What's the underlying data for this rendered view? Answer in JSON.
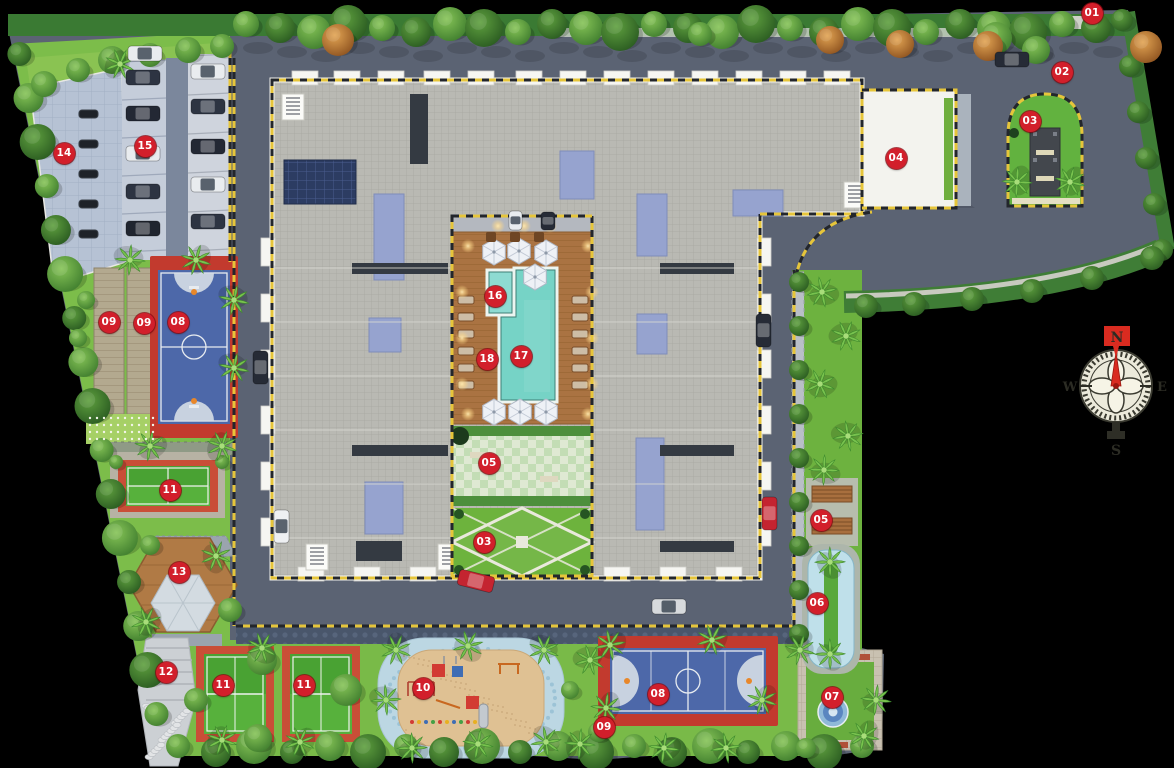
{
  "plan": {
    "title": "residential-site-plan",
    "markers": [
      {
        "label": "01",
        "x": 1092,
        "y": 13
      },
      {
        "label": "02",
        "x": 1062,
        "y": 72
      },
      {
        "label": "03",
        "x": 1030,
        "y": 121
      },
      {
        "label": "04",
        "x": 896,
        "y": 158
      },
      {
        "label": "14",
        "x": 64,
        "y": 153
      },
      {
        "label": "15",
        "x": 145,
        "y": 146
      },
      {
        "label": "09",
        "x": 109,
        "y": 322
      },
      {
        "label": "09",
        "x": 144,
        "y": 323
      },
      {
        "label": "08",
        "x": 178,
        "y": 322
      },
      {
        "label": "16",
        "x": 495,
        "y": 296
      },
      {
        "label": "18",
        "x": 487,
        "y": 359
      },
      {
        "label": "17",
        "x": 521,
        "y": 356
      },
      {
        "label": "05",
        "x": 489,
        "y": 463
      },
      {
        "label": "03",
        "x": 484,
        "y": 542
      },
      {
        "label": "11",
        "x": 170,
        "y": 490
      },
      {
        "label": "13",
        "x": 179,
        "y": 572
      },
      {
        "label": "12",
        "x": 166,
        "y": 672
      },
      {
        "label": "11",
        "x": 223,
        "y": 685
      },
      {
        "label": "11",
        "x": 304,
        "y": 685
      },
      {
        "label": "10",
        "x": 423,
        "y": 688
      },
      {
        "label": "09",
        "x": 604,
        "y": 727
      },
      {
        "label": "08",
        "x": 658,
        "y": 694
      },
      {
        "label": "07",
        "x": 832,
        "y": 697
      },
      {
        "label": "05",
        "x": 821,
        "y": 520
      },
      {
        "label": "06",
        "x": 817,
        "y": 603
      }
    ],
    "compass": {
      "north": "N",
      "east": "E",
      "south": "S",
      "west": "W"
    },
    "palette": {
      "marker_red": "#d21f2b",
      "road": "#5b6373",
      "roof": "#b9b9b3",
      "parapet": "#f2f2ee",
      "roof_shade": "#96a3cf",
      "solar_navy": "#2c3c62",
      "pool_aqua": "#76d3c6",
      "deck_wood": "#aa7342",
      "grass": "#7cbd4a",
      "hedge": "#3a7a33",
      "court_blue": "#4d68a9",
      "court_red": "#c23a2e",
      "tennis_green": "#57b13c",
      "tennis_border": "#c94e37",
      "sand": "#dfc193",
      "pebble_blue": "#bcd7e3",
      "water": "#bfe0ea",
      "parking_pave": "#b6c2d4"
    }
  }
}
